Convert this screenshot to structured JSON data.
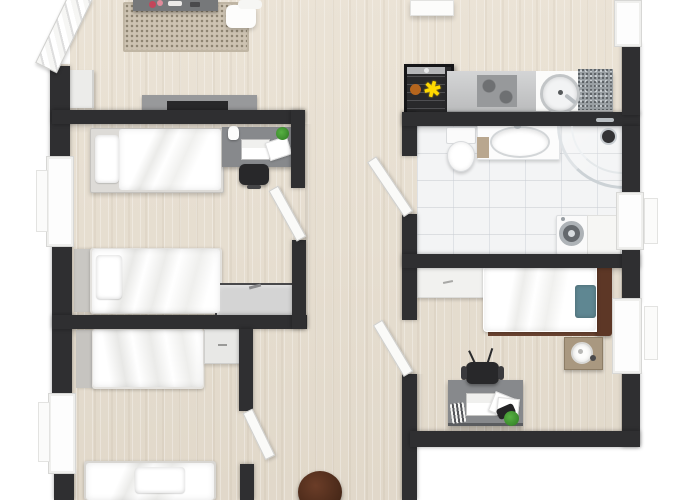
{
  "meta": {
    "description": "Top-down 3D rendered floor plan (dollhouse view) of an apartment, cropped at top and bottom edges",
    "visible_text": "none",
    "canvas": {
      "width": 700,
      "height": 500
    }
  },
  "palette": {
    "outside": "#ffffff",
    "wall": "#2f2f31",
    "floorWood": "#e8dfd0",
    "floorTile": "#f3f4f5",
    "counterGray": "#c6c7c8",
    "cooktopGray": "#97999b",
    "graniteGray": "#9aa0a4",
    "deskGray": "#87898c",
    "consoleGray": "#98999b",
    "chestGray": "#d4d4d4",
    "rugBeige": "#cdc3b2",
    "tealPillow": "#5f8792",
    "headboardWood": "#5d3726",
    "bedRailWood": "#6b4431",
    "nightstandTan": "#a99880",
    "vanityWood": "#b9a78f",
    "plantGreen": "#3f9a2f",
    "applianceDark": "#29292b",
    "applianceYellow": "#ffd900",
    "applianceOrange": "#b5651d",
    "poufBrown": "#4f2c1d",
    "chrome": "#b9bec2",
    "tvDark": "#28282a"
  },
  "rooms": [
    {
      "id": "living-area",
      "label": "Open living area (top left, cropped by image edge)",
      "furniture": [
        "coffee table with flower decor (cropped)",
        "dotted beige rug",
        "white sofa (cropped)",
        "TV sideboard with flat TV",
        "white entry cabinet",
        "open entry door with chevron panels"
      ]
    },
    {
      "id": "kitchen",
      "label": "Open kitchen (top right)",
      "furniture": [
        "dark display cabinet with yellow plant and orange bowl",
        "worktop with dark cooktop zone",
        "round basin sink with faucet",
        "granite worktop section"
      ]
    },
    {
      "id": "bedroom-left-upper",
      "label": "Twin bedroom (left) with two single beds",
      "furniture": [
        "single bed with pillow (top, along wall)",
        "desk with laptop, papers, plant, figurine",
        "black office chair",
        "second single bed with headboard panel",
        "gray storage chest"
      ]
    },
    {
      "id": "bedroom-left-lower",
      "label": "Twin bedroom (bottom left, cropped)",
      "furniture": [
        "single bed with rumpled duvet",
        "small white cabinet",
        "second single bed (cropped at bottom edge)"
      ]
    },
    {
      "id": "bathroom",
      "label": "Bathroom (right, white tiled)",
      "furniture": [
        "toilet with cistern",
        "white vanity with oval basin and wood side",
        "curved glass corner shower",
        "round dark wall mirror",
        "front-load washing machine",
        "white side cabinet"
      ]
    },
    {
      "id": "bedroom-right",
      "label": "Bedroom (right)",
      "furniture": [
        "single bed with teal pillow, wood headboard and rails",
        "low white dresser",
        "tan nightstand with round lamp",
        "gray desk with laptop, papers, pen cup, plant",
        "black office chair"
      ]
    },
    {
      "id": "hallway",
      "label": "Central hallway (wood floor)",
      "furniture": [
        "dark brown pouf (cropped at bottom edge)"
      ]
    }
  ],
  "openings": {
    "windows": [
      "left wall upper (next to twin bedroom)",
      "left wall lower (next to cropped bedroom)",
      "top right corner window",
      "right wall bathroom window",
      "right wall bedroom window (open pane)",
      "white ceiling unit at top center"
    ],
    "doors": [
      "entry door top-left, open (chevron pattern)",
      "left twin-bedroom door (open into room)",
      "bathroom door (open into hallway)",
      "right bedroom door (open into hallway)",
      "lower-left bedroom door (open into hallway)"
    ]
  }
}
